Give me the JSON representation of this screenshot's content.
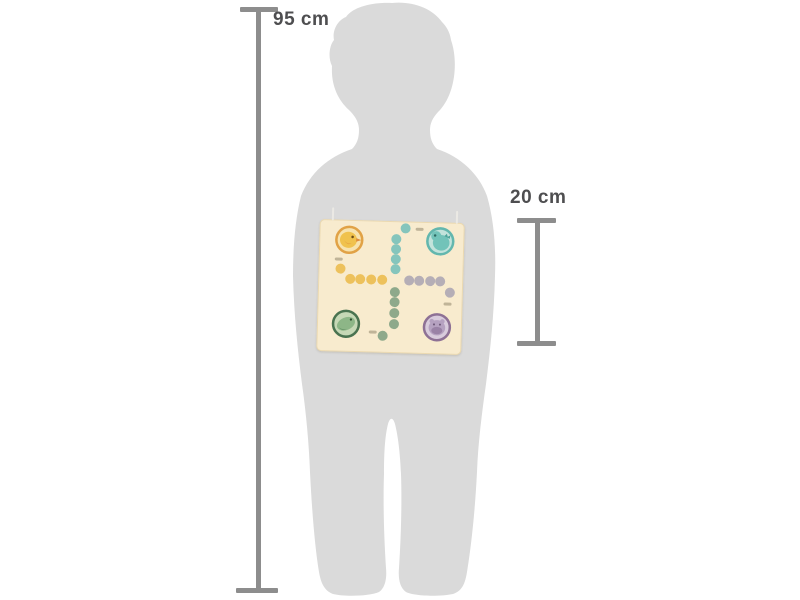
{
  "page": {
    "background": "#ffffff"
  },
  "measurements": {
    "child": {
      "label": "95 cm"
    },
    "board": {
      "label": "20 cm"
    },
    "line_color": "#8d8d8d",
    "label_color": "#4e4e50"
  },
  "silhouette": {
    "subject": "toddler-child",
    "color": "#dadada"
  },
  "board": {
    "background": "#f8ebce",
    "string_color": "#ebe9e4",
    "corners": [
      {
        "id": "duck",
        "ring": "#e1a246",
        "fill": "#f7e3ae",
        "body": "#f0c24d",
        "accent": "#e08f3c",
        "eye": "#6b4c17"
      },
      {
        "id": "dino",
        "ring": "#63b7ae",
        "fill": "#c2e3db",
        "body": "#72c3b9",
        "accent": "#4da49a",
        "eye": "#2f6b63"
      },
      {
        "id": "crocodile",
        "ring": "#4a7350",
        "fill": "#c6d8b6",
        "body": "#8db687",
        "accent": "#5d8a5e",
        "eye": "#2c4a2e"
      },
      {
        "id": "hippo",
        "ring": "#8e7195",
        "fill": "#d8cbdc",
        "body": "#b5a1c0",
        "accent": "#9a82a6",
        "eye": "#6e5878"
      }
    ],
    "dot_colors": {
      "teal": "#85c5bc",
      "yellow": "#edc15c",
      "gray": "#b5aeb6",
      "green": "#8ea98b"
    },
    "dots": [
      {
        "x": 86,
        "y": 7,
        "c": "teal"
      },
      {
        "x": 77,
        "y": 18,
        "c": "teal"
      },
      {
        "x": 77,
        "y": 28,
        "c": "teal"
      },
      {
        "x": 77,
        "y": 38,
        "c": "teal"
      },
      {
        "x": 77,
        "y": 48,
        "c": "teal"
      },
      {
        "x": 22,
        "y": 49,
        "c": "yellow"
      },
      {
        "x": 32,
        "y": 59,
        "c": "yellow"
      },
      {
        "x": 42,
        "y": 59,
        "c": "yellow"
      },
      {
        "x": 53,
        "y": 59,
        "c": "yellow"
      },
      {
        "x": 64,
        "y": 59,
        "c": "yellow"
      },
      {
        "x": 91,
        "y": 59,
        "c": "gray"
      },
      {
        "x": 101,
        "y": 59,
        "c": "gray"
      },
      {
        "x": 112,
        "y": 59,
        "c": "gray"
      },
      {
        "x": 122,
        "y": 59,
        "c": "gray"
      },
      {
        "x": 132,
        "y": 70,
        "c": "gray"
      },
      {
        "x": 77,
        "y": 71,
        "c": "green"
      },
      {
        "x": 77,
        "y": 81,
        "c": "green"
      },
      {
        "x": 77,
        "y": 92,
        "c": "green"
      },
      {
        "x": 77,
        "y": 103,
        "c": "green"
      },
      {
        "x": 66,
        "y": 115,
        "c": "green"
      }
    ],
    "markings": [
      {
        "x": 20,
        "y": 39
      },
      {
        "x": 100,
        "y": 7
      },
      {
        "x": 130,
        "y": 81
      },
      {
        "x": 56,
        "y": 111
      }
    ]
  }
}
